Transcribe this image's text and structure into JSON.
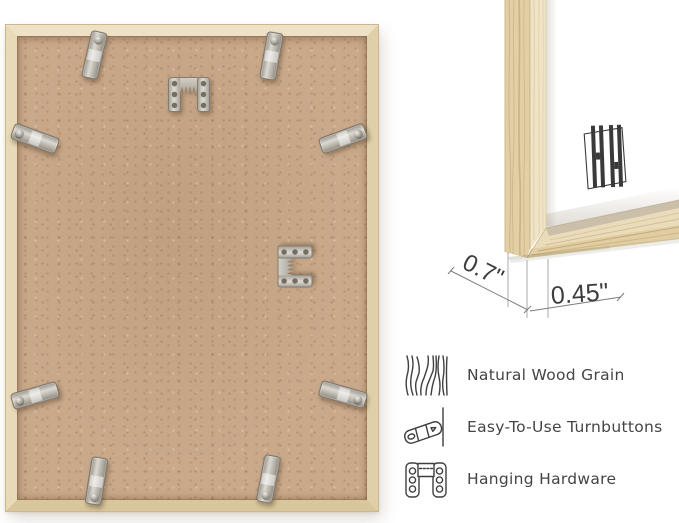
{
  "page": {
    "background": "#ffffff"
  },
  "frame_back_photo": {
    "description": "back of wood frame with kraft backing board",
    "turnbutton_count": 8,
    "hanger_count": 2,
    "colors": {
      "wood": "#e7d8b6",
      "backing": "#c9a98a",
      "metal": "#b9b5ad"
    }
  },
  "corner_detail": {
    "measurements": [
      {
        "id": "frame-depth",
        "value": "0.7\""
      },
      {
        "id": "frame-face-width",
        "value": "0.45\""
      }
    ],
    "logo": "hh-monogram",
    "colors": {
      "wood_face": "#efe4c6",
      "wood_side": "#e2cfa6",
      "mat": "#ffffff",
      "line": "#8f8f8f",
      "text": "#3d3d3d"
    }
  },
  "features": [
    {
      "icon": "wood-grain-icon",
      "label": "Natural Wood Grain"
    },
    {
      "icon": "turnbutton-icon",
      "label": "Easy-To-Use Turnbuttons"
    },
    {
      "icon": "hanging-hardware-icon",
      "label": "Hanging Hardware"
    }
  ]
}
